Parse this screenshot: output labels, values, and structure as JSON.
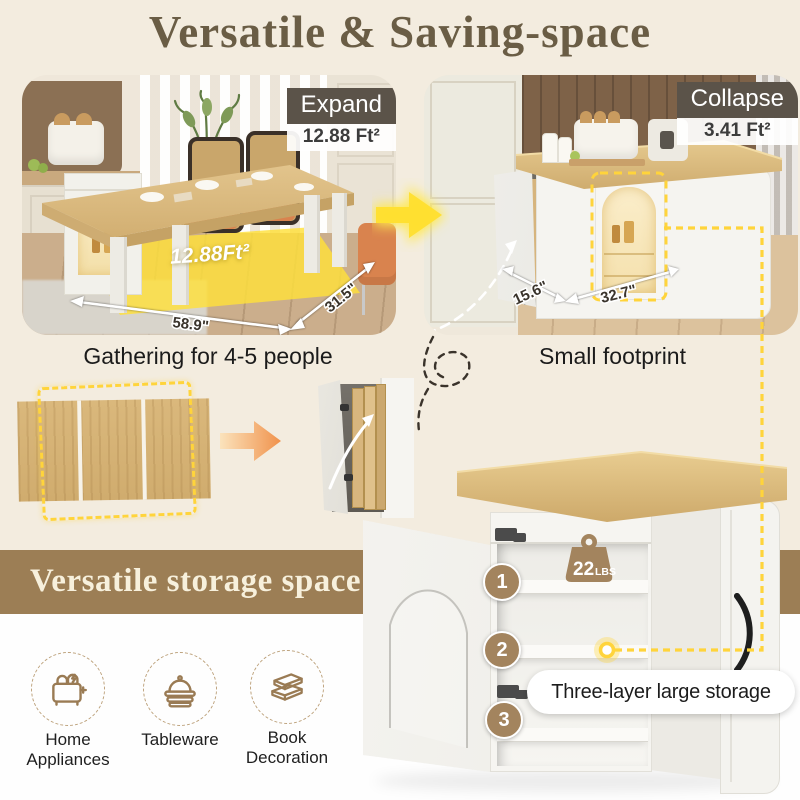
{
  "title": "Versatile & Saving-space",
  "photos": {
    "expand": {
      "tag": "Expand",
      "area": "12.88 Ft²",
      "floor_area": "12.88Ft²",
      "width": "58.9\"",
      "depth": "31.5\"",
      "caption": "Gathering for 4-5 people"
    },
    "collapse": {
      "tag": "Collapse",
      "area": "3.41 Ft²",
      "depth": "15.6\"",
      "width": "32.7\"",
      "caption": "Small footprint"
    }
  },
  "storage": {
    "banner": "Versatile storage space",
    "categories": [
      {
        "icon": "toaster-icon",
        "label": "Home Appliances"
      },
      {
        "icon": "tableware-icon",
        "label": "Tableware"
      },
      {
        "icon": "books-icon",
        "label": "Book Decoration"
      }
    ],
    "weight_value": "22",
    "weight_unit": "LBS",
    "shelves": [
      "1",
      "2",
      "3"
    ],
    "callout": "Three-layer large storage"
  },
  "colors": {
    "background_cream": "#F3ECDF",
    "title_brown": "#6A5D45",
    "tag_dark": "#5B5349",
    "accent_yellow": "#FFD43B",
    "band_brown": "#9C7E55",
    "wood": "#D9B87C",
    "orange_arrow": "#F0924C",
    "badge_tan": "#A3845E"
  }
}
